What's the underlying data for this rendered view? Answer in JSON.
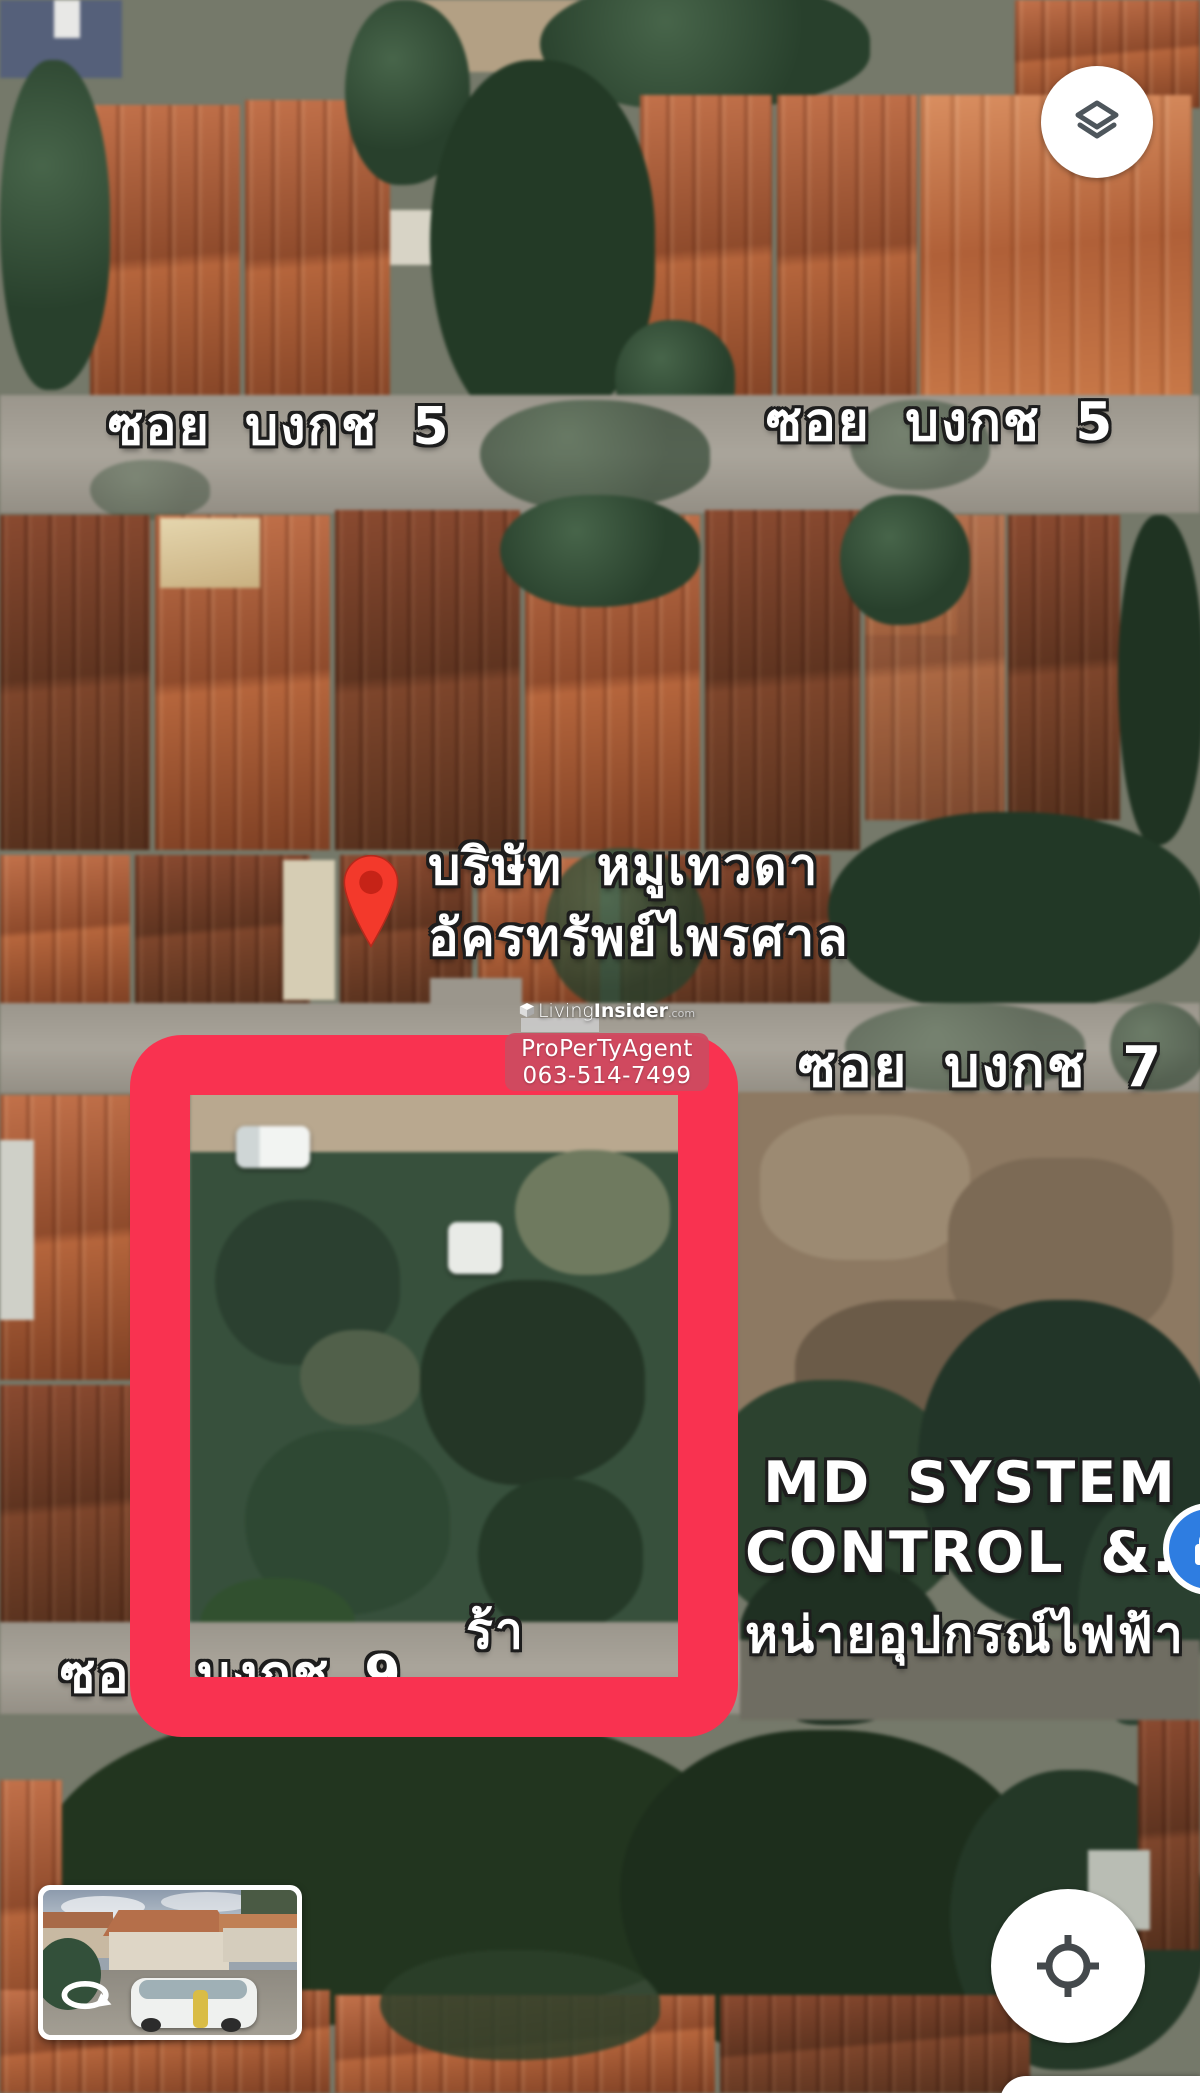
{
  "street_labels": {
    "bongkot5_left": "ซอย บงกช 5",
    "bongkot5_right": "ซอย บงกช 5",
    "bongkot7": "ซอย บงกช 7",
    "bongkot9": "ซอย บงกช 9"
  },
  "poi": {
    "company_pin": {
      "line1": "บริษัท หมูเทวดา",
      "line2": "อัครทรัพย์ไพรศาล",
      "pin_color": "#f3392b"
    },
    "md_system": {
      "line1": "MD SYSTEM",
      "line2": "CONTROL &...",
      "thai_fragment_left": "ร้า",
      "thai_fragment_right": "หน่ายอุปกรณ์ไฟฟ้า"
    },
    "store_icon_color": "#2e7de1"
  },
  "highlight_rectangle": {
    "color": "#f93250"
  },
  "watermark": {
    "brand_living": "Living",
    "brand_insider": "Insider",
    "brand_tld": ".com",
    "agent_name": "ProPerTyAgent",
    "phone": "063-514-7499",
    "box_color": "#cd4b60"
  },
  "controls": {
    "layers_button_icon": "layers",
    "locate_button_icon": "my-location-crosshair",
    "street_view_icon": "rotate-arrow"
  }
}
